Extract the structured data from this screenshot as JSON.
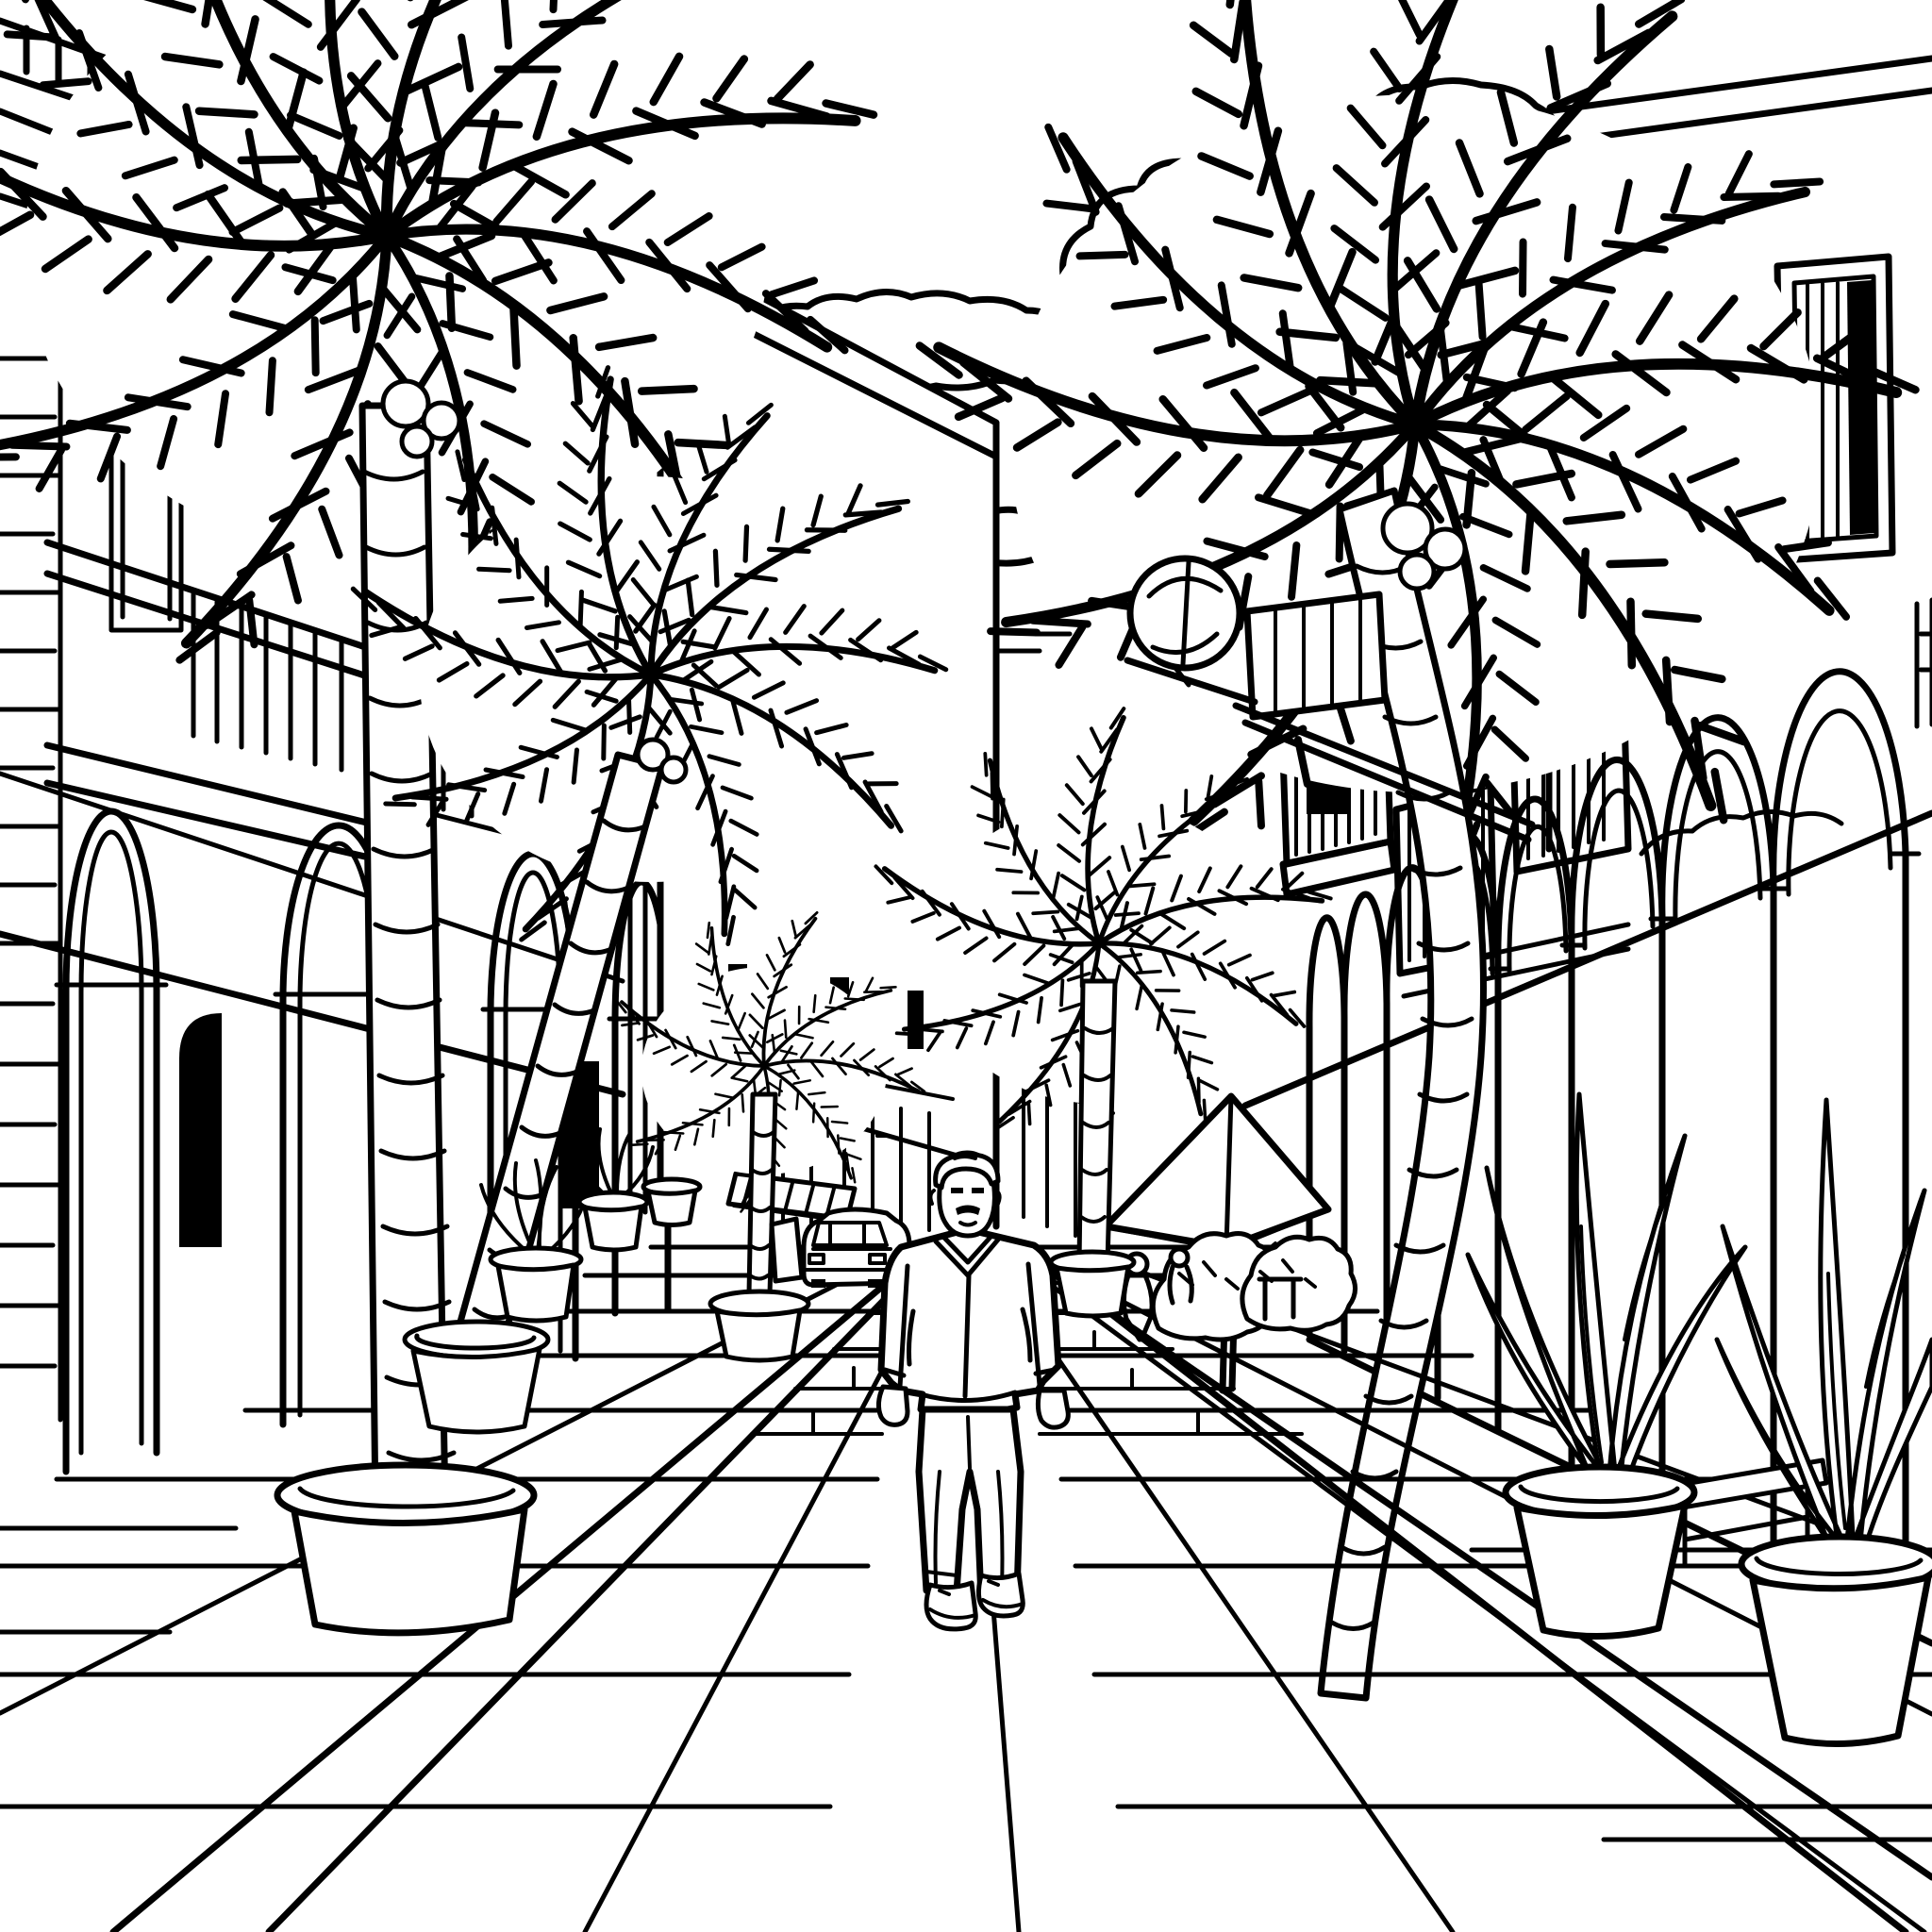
{
  "meta": {
    "title": "Palm Street Coloring Page",
    "alt": "Black-and-white line drawing of a tropical pedestrian street lined with palm trees, arcaded colonnade buildings with balconies, potted plants, a cafe umbrella, a globe street lamp, distant cars, puffy clouds, and a man walking toward the viewer on a tiled pavement.",
    "style": "black-and-white line art, coloring book"
  },
  "palette": {
    "background": "#ffffff",
    "line": "#000000"
  },
  "scene": {
    "setting": "tropical town street in one-point perspective",
    "objects": [
      {
        "name": "sky-clouds",
        "count": 3,
        "description": "puffy outlined cumulus clouds with small dash accents"
      },
      {
        "name": "left-building",
        "description": "arcade facade with stone quoins, balcony with balusters, arched colonnade, dark doorways"
      },
      {
        "name": "center-wall",
        "description": "tall white wall slab with capped cornice and slit windows"
      },
      {
        "name": "right-building",
        "description": "facade with shuttered window, balconies with balusters, arched colonnade"
      },
      {
        "name": "globe-street-lamp",
        "description": "spherical lamp on bracket arm with slatted box"
      },
      {
        "name": "palm-trees",
        "count": 5,
        "description": "coconut palms with ringed trunks and feathered fronds"
      },
      {
        "name": "cafe-umbrella",
        "description": "square parasol over tables, seated people and shrubs"
      },
      {
        "name": "potted-plants",
        "count": 8,
        "description": "tapered planters with palms and strap-leaf plants"
      },
      {
        "name": "bench",
        "description": "small bench between foreground planters"
      },
      {
        "name": "car",
        "description": "distant car front view on the street"
      },
      {
        "name": "walking-man",
        "description": "man in zip jacket, trousers, sneakers, walking toward viewer"
      },
      {
        "name": "tiled-pavement",
        "description": "perspective tile grid with diagonal curb bands"
      }
    ]
  }
}
